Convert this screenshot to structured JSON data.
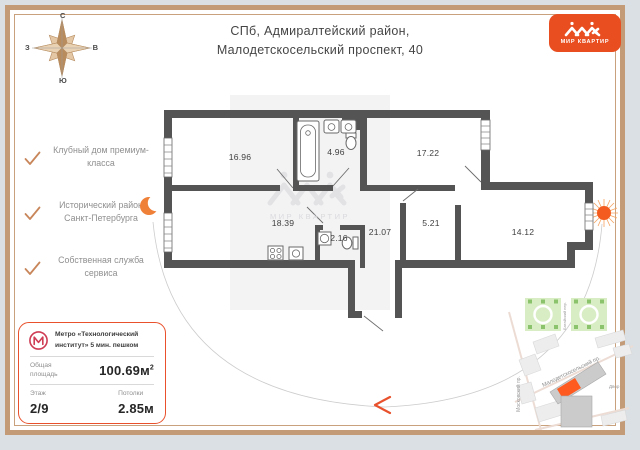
{
  "page": {
    "accent": "#e8512c",
    "frame": "#c39b77",
    "wall": "#545454"
  },
  "compass": {
    "north": "С",
    "east": "В",
    "south": "Ю",
    "west": "З"
  },
  "header": {
    "address_line1": "СПб, Адмиралтейский район,",
    "address_line2": "Малодетскосельский проспект, 40"
  },
  "logo": {
    "text": "МИР КВАРТИР"
  },
  "features": [
    {
      "label": "Клубный дом премиум-класса"
    },
    {
      "label": "Исторический район Санкт-Петербурга"
    },
    {
      "label": "Собственная служба сервиса"
    }
  ],
  "info_card": {
    "metro_line1": "Метро «Технологический",
    "metro_line2": "институт» 5 мин. пешком",
    "area_label_line1": "Общая",
    "area_label_line2": "площадь",
    "area_value": "100.69м",
    "area_sup": "2",
    "floor_label": "Этаж",
    "floor_value": "2/9",
    "ceiling_label": "Потолки",
    "ceiling_value": "2.85м"
  },
  "floorplan": {
    "watermark": "МИР КВАРТИР",
    "rooms": [
      {
        "name": "room-1",
        "area": "16.96"
      },
      {
        "name": "bathroom",
        "area": "4.96"
      },
      {
        "name": "room-2",
        "area": "17.22"
      },
      {
        "name": "kitchen-living",
        "area": "18.39"
      },
      {
        "name": "wc",
        "area": "2.16"
      },
      {
        "name": "corridor",
        "area": "21.07"
      },
      {
        "name": "wardrobe",
        "area": "5.21"
      },
      {
        "name": "room-3",
        "area": "14.12"
      }
    ]
  },
  "map": {
    "street_diagonal": "Малодетскосельский пр.",
    "street_vertical": "Московский пр.",
    "street_between_parks": "Батайский пер.",
    "yard_label": "Двор"
  }
}
